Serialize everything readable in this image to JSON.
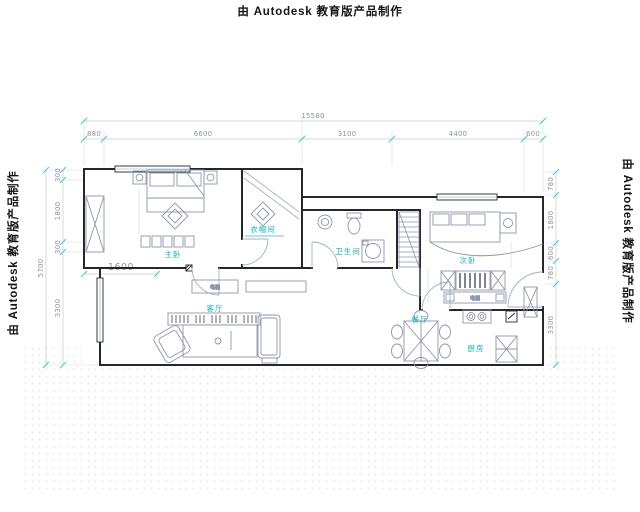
{
  "watermarks": {
    "top": "由 Autodesk 教育版产品制作",
    "left": "由 Autodesk 教育版产品制作",
    "right": "由 Autodesk 教育版产品制作"
  },
  "dimensions": {
    "top_total": "15580",
    "top_segments": [
      "880",
      "6600",
      "3100",
      "4400",
      "600"
    ],
    "left_total": "5700",
    "left_segments": [
      "300",
      "1800",
      "300",
      "3300"
    ],
    "right_segments": [
      "780",
      "1800",
      "600",
      "780",
      "3300"
    ],
    "interior_width": "1600"
  },
  "rooms": {
    "master_bedroom": "主卧",
    "cloakroom": "衣帽间",
    "bathroom": "卫生间",
    "second_bedroom": "次卧",
    "living_room": "客厅",
    "dining_room": "餐厅",
    "kitchen": "厨房"
  },
  "furniture_labels": {
    "tv_cabinet": "电视",
    "bedroom_tv": "电视"
  },
  "colors": {
    "wall": "#26262e",
    "furniture": "#8e96aa",
    "dimension_line": "#c2cbd2",
    "dimension_tick": "#55c6d2",
    "room_label": "#14b1bb",
    "window": "#8fcfd4"
  }
}
